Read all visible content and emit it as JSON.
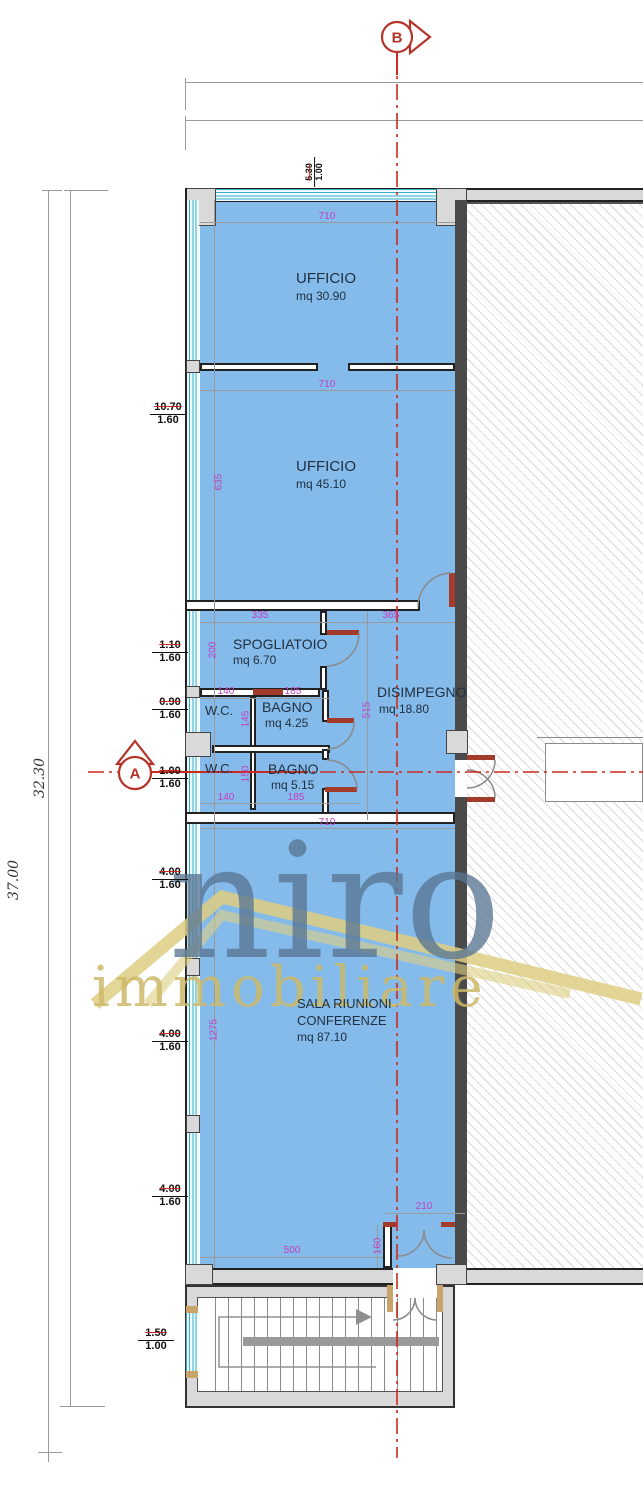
{
  "plan": {
    "markers": {
      "b": "B",
      "a": "A"
    },
    "overall": {
      "height_total": "37.00",
      "height_inner": "32.30"
    },
    "windows": {
      "top": {
        "w": "5.30",
        "h": "1.00"
      },
      "w1": {
        "w": "10.70",
        "h": "1.60"
      },
      "w2": {
        "w": "1.10",
        "h": "1.60"
      },
      "w3": {
        "w": "0.90",
        "h": "1.60"
      },
      "w4": {
        "w": "1.00",
        "h": "1.60"
      },
      "w5": {
        "w": "4.00",
        "h": "1.60"
      },
      "w6": {
        "w": "4.00",
        "h": "1.60"
      },
      "w7": {
        "w": "4.00",
        "h": "1.60"
      },
      "w8": {
        "w": "1.50",
        "h": "1.00"
      }
    },
    "rooms": {
      "ufficio1": {
        "name": "UFFICIO",
        "area": "mq 30.90"
      },
      "ufficio2": {
        "name": "UFFICIO",
        "area": "mq 45.10"
      },
      "spogliatoio": {
        "name": "SPOGLIATOIO",
        "area": "mq 6.70"
      },
      "wc1": {
        "name": "W.C."
      },
      "bagno1": {
        "name": "BAGNO",
        "area": "mq 4.25"
      },
      "disimpegno": {
        "name": "DISIMPEGNO",
        "area": "mq 18.80"
      },
      "wc2": {
        "name": "W.C."
      },
      "bagno2": {
        "name": "BAGNO",
        "area": "mq 5.15"
      },
      "sala": {
        "name1": "SALA RIUNIONI",
        "name2": "CONFERENZE",
        "area": "mq 87.10"
      }
    },
    "dims": {
      "t710a": "710",
      "t710b": "710",
      "t710c": "710",
      "v635": "635",
      "h335": "335",
      "h365": "365",
      "v200": "200",
      "h140a": "140",
      "h185a": "185",
      "v145": "145",
      "v515": "515",
      "v150": "150",
      "h140b": "140",
      "h185b": "185",
      "v1275": "1275",
      "h210": "210",
      "v160": "160",
      "h500": "500"
    },
    "watermark": {
      "brand": "niro",
      "subtitle": "immobiliare"
    },
    "colors": {
      "room_fill": "#84BBEB",
      "glass": "#35AEC6",
      "dim_text": "#C03FC0",
      "section_red": "#C92A21",
      "partition_red": "#A33B2B"
    }
  }
}
